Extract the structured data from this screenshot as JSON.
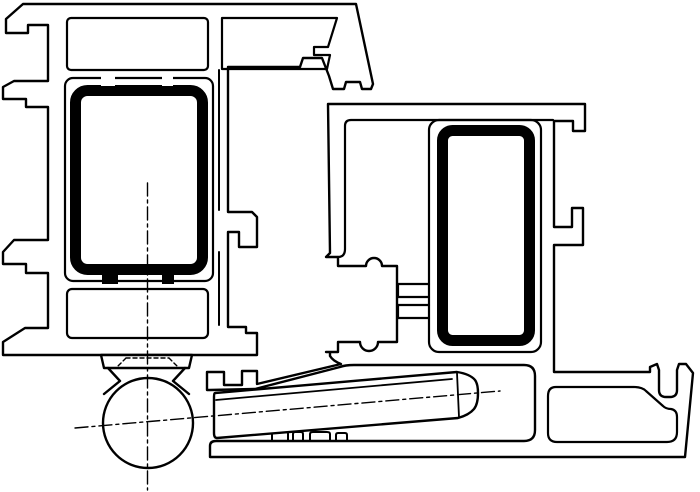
{
  "diagram": {
    "type": "technical-cross-section",
    "description": "CAD line drawing: cross-section of two window frame profiles (sash and frame) with steel reinforcement tubes and a surface-mounted barrel hinge with knuckle and tapered hinge arm",
    "colors": {
      "background": "#ffffff",
      "line": "#000000",
      "steel_fill": "#000000",
      "white": "#ffffff"
    },
    "line_styles": {
      "contour_width": 2.4,
      "thin_width": 2,
      "steel_band_width": 11,
      "centerline_width": 1.4,
      "centerline_dash": "13 4 3 4",
      "hidden_line_dash": "4 3"
    },
    "elements": {
      "left_profile": "sash profile cross-section with glazing hooks on left side",
      "left_steel": {
        "x": 70,
        "y": 85,
        "w": 138,
        "h": 190,
        "band": 11
      },
      "right_profile": "frame profile cross-section with hinge-arm slot and screw channel",
      "right_steel": {
        "x": 437,
        "y": 125,
        "w": 98,
        "h": 221,
        "band": 11
      },
      "hinge_knuckle": {
        "cx": 148,
        "cy": 423,
        "r": 45
      },
      "hinge_arm": {
        "x1": 214,
        "y1": 393,
        "x2": 479,
        "y2": 410
      },
      "vertical_centerline": {
        "x": 147.5,
        "y1": 183,
        "y2": 490
      },
      "arm_axis": {
        "x1": 75,
        "y1": 428,
        "x2": 500,
        "y2": 391
      }
    }
  }
}
